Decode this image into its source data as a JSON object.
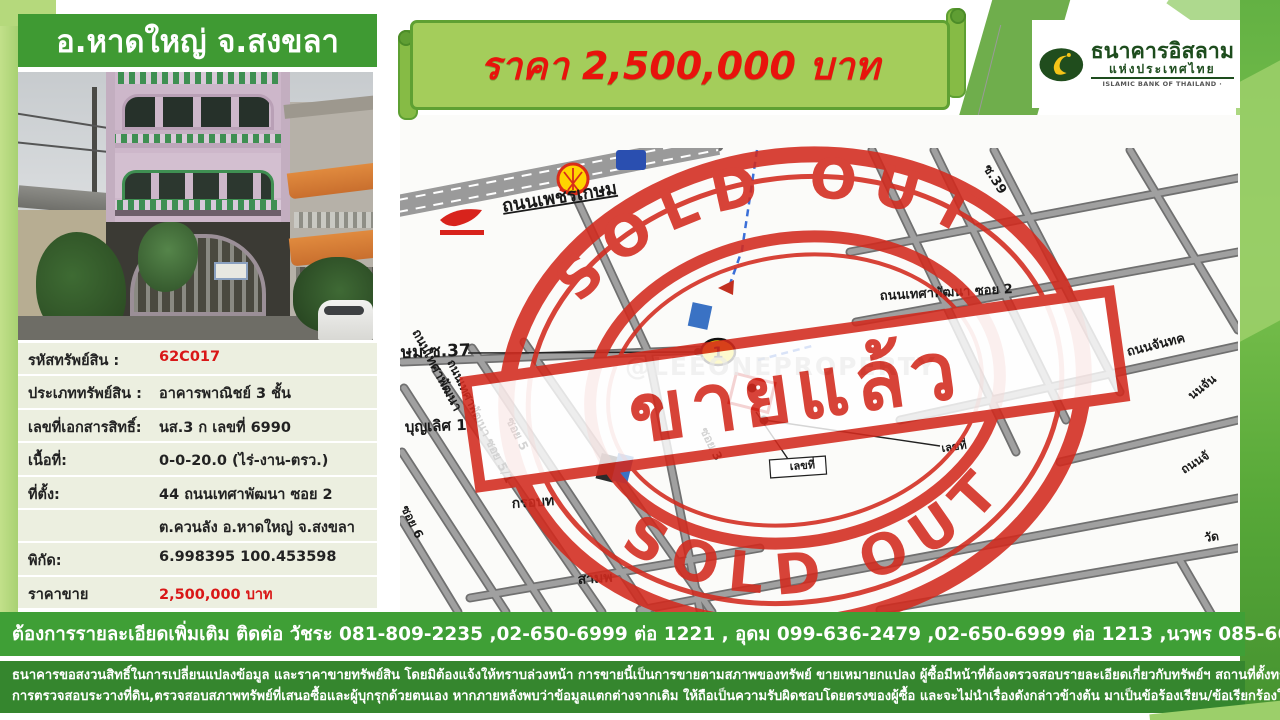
{
  "header": {
    "title": "อ.หาดใหญ่ จ.สงขลา"
  },
  "price_banner": {
    "text": "ราคา 2,500,000 บาท"
  },
  "bank_logo": {
    "name_th": "ธนาคารอิสลาม",
    "name_th2": "แห่งประเทศไทย",
    "name_en": "ISLAMIC BANK OF THAILAND  ·"
  },
  "colors": {
    "header_green": "#3f9a33",
    "light_green": "#a8d172",
    "banner_fill": "#a4cd5b",
    "banner_border": "#5ea032",
    "accent_red": "#e8130c",
    "table_bg": "#ecefe0",
    "contact_bar_green": "#3f9f36",
    "disclaimer_green": "#35862e",
    "stamp_red": "#d32a1e"
  },
  "property_table": {
    "rows": [
      {
        "label": "รหัสทรัพย์สิน :",
        "value": "62C017",
        "value_color": "red"
      },
      {
        "label": "ประเภททรัพย์สิน :",
        "value": "อาคารพาณิชย์ 3 ชั้น",
        "value_color": "black"
      },
      {
        "label": "เลขที่เอกสารสิทธิ์:",
        "value": "นส.3 ก เลขที่ 6990",
        "value_color": "black"
      },
      {
        "label": "เนื้อที่:",
        "value": "0-0-20.0  (ไร่-งาน-ตรว.)",
        "value_color": "black"
      },
      {
        "label": "ที่ตั้ง:",
        "value": "44 ถนนเทศาพัฒนา ซอย 2",
        "value_color": "black"
      },
      {
        "label": "",
        "value": "ต.ควนลัง อ.หาดใหญ่ จ.สงขลา",
        "value_color": "black"
      },
      {
        "label": "พิกัด:",
        "value": "6.998395  100.453598",
        "value_color": "black"
      },
      {
        "label": "ราคาขาย",
        "value": "2,500,000 บาท",
        "value_color": "red"
      }
    ]
  },
  "map": {
    "watermark": "@LEEONEPROPERTY",
    "marker_number": "1",
    "stamp": {
      "arc_top": "SOLD OUT",
      "arc_bottom": "SOLD OUT",
      "center": "ขายแล้ว"
    },
    "labels": [
      {
        "text": "ถนนเพชรเกษม",
        "x": 503,
        "y": 212,
        "r": -9,
        "s": 18,
        "u": 1
      },
      {
        "text": "ษม ซ.37",
        "x": 401,
        "y": 358,
        "r": -2,
        "s": 17
      },
      {
        "text": "บุญเลิศ 1",
        "x": 405,
        "y": 432,
        "r": -2,
        "s": 15
      },
      {
        "text": "ถนนเทศาพัฒนา",
        "x": 412,
        "y": 332,
        "r": 62,
        "s": 13
      },
      {
        "text": "ถนนเทศาพัฒนา ซอย 5/1",
        "x": 447,
        "y": 362,
        "r": 64,
        "s": 12
      },
      {
        "text": "ซอย 5",
        "x": 506,
        "y": 420,
        "r": 64,
        "s": 12
      },
      {
        "text": "ซอย 6",
        "x": 401,
        "y": 508,
        "r": 64,
        "s": 12
      },
      {
        "text": "ซอย 3",
        "x": 700,
        "y": 430,
        "r": 64,
        "s": 12
      },
      {
        "text": "กรอบท",
        "x": 512,
        "y": 508,
        "r": -4,
        "s": 14
      },
      {
        "text": "สามพ",
        "x": 578,
        "y": 584,
        "r": -4,
        "s": 14
      },
      {
        "text": "ถนนเทศาพัฒนา ซอย 2",
        "x": 880,
        "y": 300,
        "r": -3,
        "s": 13
      },
      {
        "text": "ซ.39",
        "x": 983,
        "y": 168,
        "r": 58,
        "s": 13
      },
      {
        "text": "ถนนจันทค",
        "x": 1128,
        "y": 356,
        "r": -14,
        "s": 13
      },
      {
        "text": "นนจัน",
        "x": 1192,
        "y": 400,
        "r": -38,
        "s": 12
      },
      {
        "text": "ถนนจั",
        "x": 1184,
        "y": 474,
        "r": -32,
        "s": 12
      },
      {
        "text": "วัด",
        "x": 1205,
        "y": 542,
        "r": -8,
        "s": 12
      },
      {
        "text": "เลขที่",
        "x": 790,
        "y": 470,
        "r": -4,
        "s": 11
      },
      {
        "text": "เลขที่",
        "x": 942,
        "y": 452,
        "r": -8,
        "s": 11
      }
    ]
  },
  "contact_bar": {
    "text": "ต้องการรายละเอียดเพิ่มเติม ติดต่อ วัชระ 081-809-2235 ,02-650-6999 ต่อ 1221  , อุดม 099-636-2479 ,02-650-6999 ต่อ 1213 ,นวพร 085-660-6093 , 02-650-69999 ต่อ 8075"
  },
  "disclaimer": {
    "line1": "ธนาคารขอสงวนสิทธิ์ในการเปลี่ยนแปลงข้อมูล และราคาขายทรัพย์สิน โดยมิต้องแจ้งให้ทราบล่วงหน้า การขายนี้เป็นการขายตามสภาพของทรัพย์ ขายเหมายกแปลง ผู้ซื้อมีหน้าที่ต้องตรวจสอบรายละเอียดเกี่ยวกับทรัพย์ฯ สถานที่ตั้งทรัพย์,แผนที่การเดินทาง,",
    "line2": "การตรวจสอบระวางที่ดิน,ตรวจสอบสภาพทรัพย์ที่เสนอซื้อและผู้บุกรุกด้วยตนเอง หากภายหลังพบว่าข้อมูลแตกต่างจากเดิม ให้ถือเป็นความรับผิดชอบโดยตรงของผู้ซื้อ และจะไม่นำเรื่องดังกล่าวข้างต้น มาเป็นข้อร้องเรียน/ข้อเรียกร้องใดๆต่อธนาคาร"
  }
}
